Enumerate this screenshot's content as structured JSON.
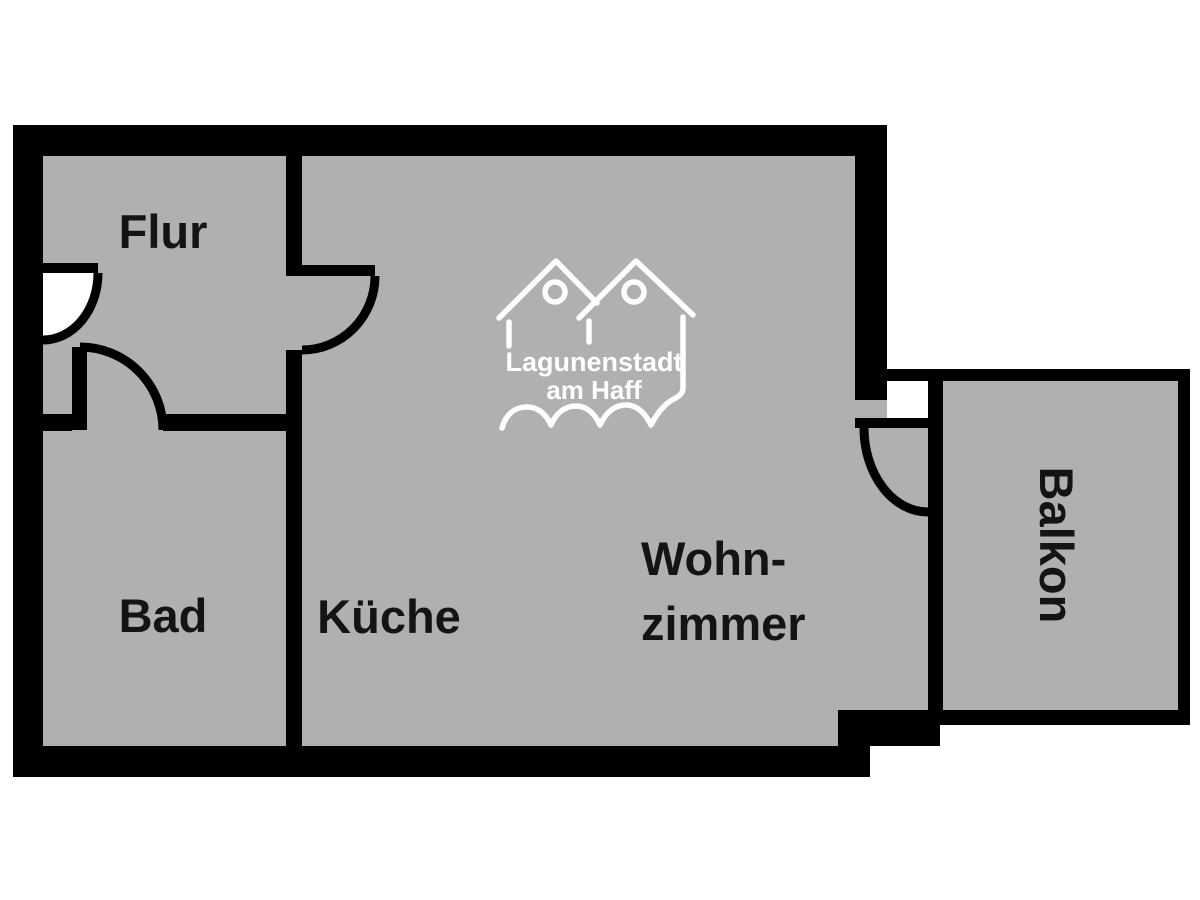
{
  "title": "Grundriss Ferienwohnung",
  "colors": {
    "background": "#ffffff",
    "floor": "#b1b0ae",
    "wall": "#000000",
    "label": "#141414",
    "logo": "#ffffff"
  },
  "rooms": {
    "flur": {
      "label": "Flur"
    },
    "bad": {
      "label": "Bad"
    },
    "kueche": {
      "label": "Küche"
    },
    "wohnzimmer": {
      "label_line1": "Wohn-",
      "label_line2": "zimmer"
    },
    "balkon": {
      "label": "Balkon"
    }
  },
  "logo": {
    "name_line1": "Lagunenstadt",
    "name_line2": "am Haff"
  }
}
